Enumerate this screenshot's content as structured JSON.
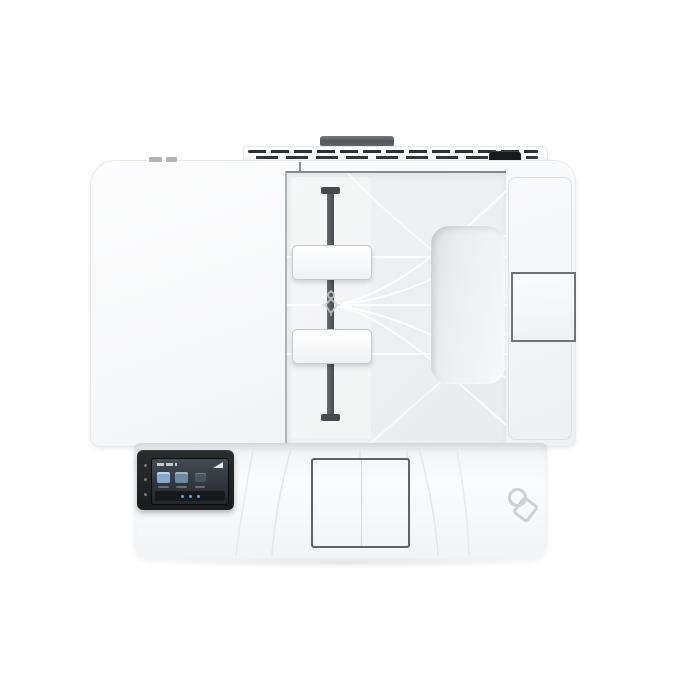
{
  "image": {
    "subject": "white multifunction laser printer, top-down product photo",
    "background_color": "#ffffff"
  },
  "colors": {
    "body_white": "#f6f7f9",
    "adf_recess": "#ebedef",
    "decor_line_white": "#ffffff",
    "dark_hardware": "#474a4d",
    "handle_bar": "#53565a",
    "vent_dark": "#2d3032",
    "rear_port_black": "#17191b",
    "panel_bezel_black": "#1e2022",
    "screen_background": "#2b3036",
    "screen_icon_blue": "#87abce",
    "nav_dot_blue": "#5f9bd6",
    "seam_outline_gray": "#6e7377",
    "emboss_gray": "#ced1d4"
  },
  "icons": {
    "nfc_tap": "nfc-tap-icon",
    "paper_guide_adjust": "paper-guide-adjust-icon",
    "screen_apps": [
      "app-icon-1",
      "app-icon-2",
      "app-icon-3"
    ]
  },
  "counts": {
    "paper_guides": 2,
    "vent_rows": 2,
    "panel_side_buttons": 3,
    "screen_nav_dots": 3
  }
}
